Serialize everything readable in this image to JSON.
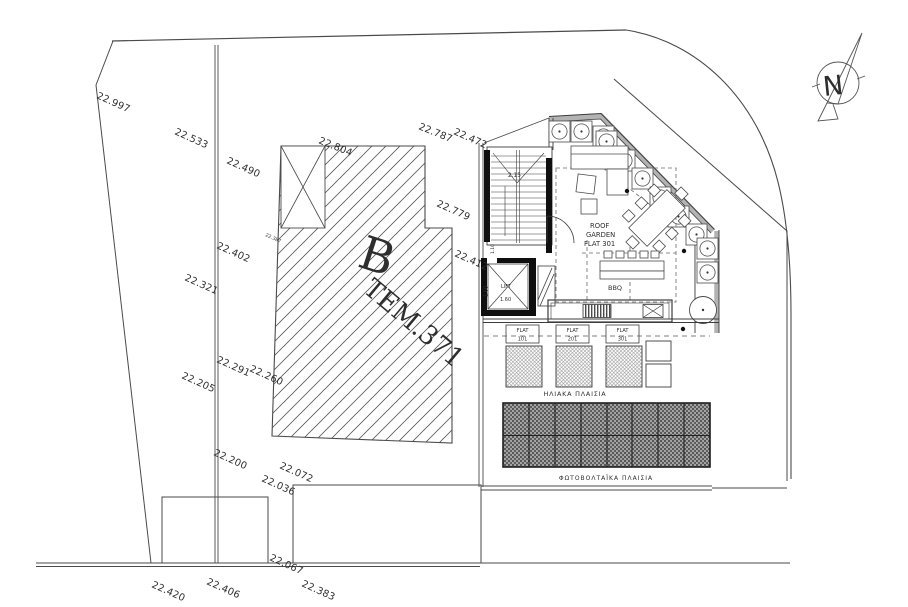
{
  "drawing": {
    "type": "architectural roof / site plan",
    "north_label": "N",
    "building": {
      "letter": "B",
      "parcel": "TEM.371"
    },
    "roof_garden": {
      "lines": [
        "ROOF",
        "GARDEN",
        "FLAT 301"
      ],
      "bbq": "BBQ"
    },
    "core": {
      "lift": "LIFT",
      "stair_dim": "2.15",
      "lift_width": "1.60",
      "lift_depth": "1.60",
      "lobby_dim": "1.10"
    },
    "solar": {
      "label": "ΗΛΙΑΚΑ  ΠΛΑΙΣΙΑ",
      "flats": [
        {
          "l1": "FLAT",
          "l2": "101"
        },
        {
          "l1": "FLAT",
          "l2": "201"
        },
        {
          "l1": "FLAT",
          "l2": "301"
        }
      ]
    },
    "pv": {
      "label": "ΦΩΤΟΒΟΛΤΑΪΚΑ ΠΛΑΙΣΙΑ"
    },
    "levels": [
      {
        "v": "22.997"
      },
      {
        "v": "22.533"
      },
      {
        "v": "22.490"
      },
      {
        "v": "22.804"
      },
      {
        "v": "22.787"
      },
      {
        "v": "22.472"
      },
      {
        "v": "22.779"
      },
      {
        "v": "22.412"
      },
      {
        "v": "22.402"
      },
      {
        "v": "22.321"
      },
      {
        "v": "22.387"
      },
      {
        "v": "22.291"
      },
      {
        "v": "22.260"
      },
      {
        "v": "22.205"
      },
      {
        "v": "22.200"
      },
      {
        "v": "22.072"
      },
      {
        "v": "22.036"
      },
      {
        "v": "22.067"
      },
      {
        "v": "22.420"
      },
      {
        "v": "22.406"
      },
      {
        "v": "22.383"
      }
    ],
    "colors": {
      "line": "#4a4a4a",
      "wall": "#111111",
      "parapet": "#b3b3b3",
      "paper": "#ffffff"
    }
  }
}
